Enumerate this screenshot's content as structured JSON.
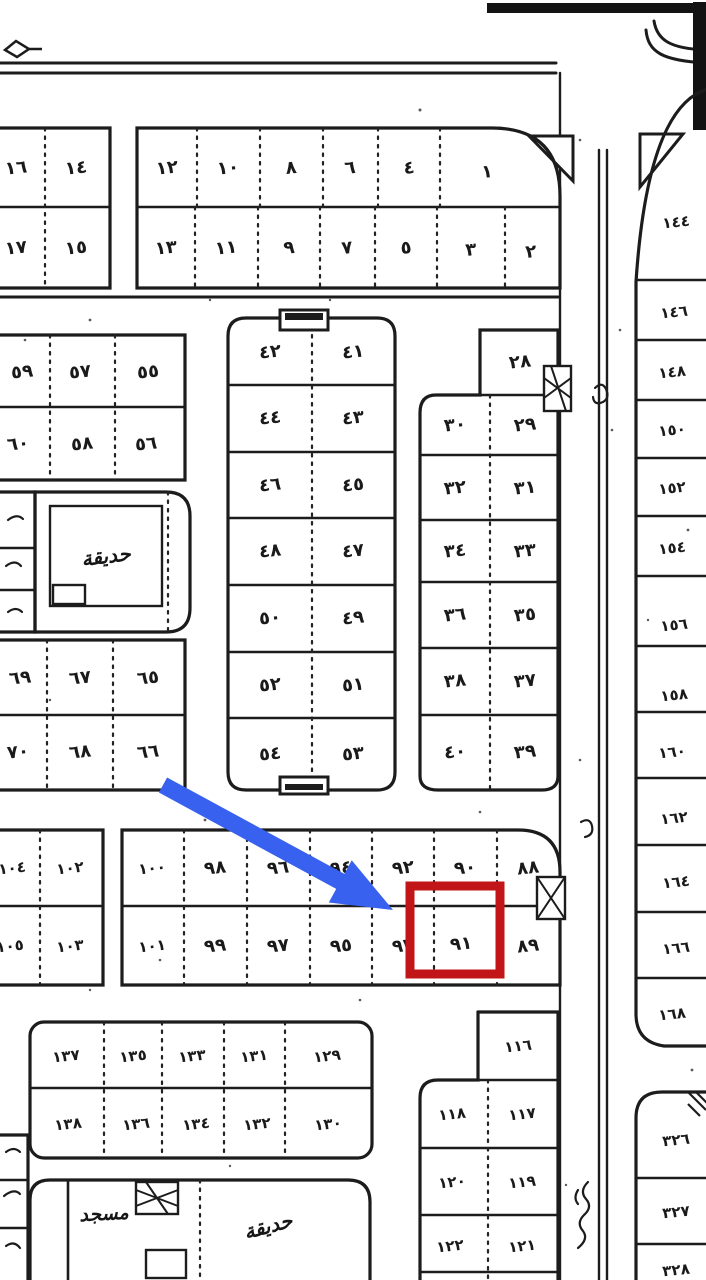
{
  "map": {
    "annotations": {
      "highlighted_plot": "٩١",
      "arrow_color": "#3761ee",
      "highlight_box_color": "#c21518"
    },
    "labels": {
      "garden_upper": "حديقة",
      "mosque": "مسجد",
      "garden_lower": "حديقة"
    },
    "blocks": {
      "top_left": {
        "row_top": [
          "١٦",
          "١٤"
        ],
        "row_bottom": [
          "١٧",
          "١٥"
        ]
      },
      "top_right": {
        "row_top": [
          "١٢",
          "١٠",
          "٨",
          "٦",
          "٤",
          "١"
        ],
        "row_bottom": [
          "١٣",
          "١١",
          "٩",
          "٧",
          "٥",
          "٣",
          "٢"
        ]
      },
      "west_upper": {
        "row_top": [
          "٥٩",
          "٥٧",
          "٥٥"
        ],
        "row_bottom": [
          "٦٠",
          "٥٨",
          "٥٦"
        ]
      },
      "west_lower": {
        "row_top": [
          "٦٩",
          "٦٧",
          "٦٥"
        ],
        "row_bottom": [
          "٧٠",
          "٦٨",
          "٦٦"
        ]
      },
      "central": {
        "col_left": [
          "٤٢",
          "٤٤",
          "٤٦",
          "٤٨",
          "٥٠",
          "٥٢",
          "٥٤"
        ],
        "col_right": [
          "٤١",
          "٤٣",
          "٤٥",
          "٤٧",
          "٤٩",
          "٥١",
          "٥٣"
        ]
      },
      "east_central": {
        "single_top": "٢٨",
        "col_left": [
          "٣٠",
          "٣٢",
          "٣٤",
          "٣٦",
          "٣٨",
          "٤٠"
        ],
        "col_right": [
          "٢٩",
          "٣١",
          "٣٣",
          "٣٥",
          "٣٧",
          "٣٩"
        ]
      },
      "mid_band_west": {
        "row_top": [
          "١٠٤",
          "١٠٢"
        ],
        "row_bottom": [
          "١٠٥",
          "١٠٣"
        ]
      },
      "mid_band_main": {
        "row_top": [
          "١٠٠",
          "٩٨",
          "٩٦",
          "٩٤",
          "٩٢",
          "٩٠",
          "٨٨"
        ],
        "row_bottom": [
          "١٠١",
          "٩٩",
          "٩٧",
          "٩٥",
          "٩٣",
          "٩١",
          "٨٩"
        ]
      },
      "south_west": {
        "row_top": [
          "١٣٧",
          "١٣٥",
          "١٣٣",
          "١٣١",
          "١٢٩"
        ],
        "row_bottom": [
          "١٣٨",
          "١٣٦",
          "١٣٤",
          "١٣٢",
          "١٣٠"
        ]
      },
      "south_central": {
        "single_top": "١١٦",
        "col_left": [
          "١١٨",
          "١٢٠",
          "١٢٢"
        ],
        "col_right": [
          "١١٧",
          "١١٩",
          "١٢١"
        ]
      },
      "east_column": {
        "cells": [
          "١٤٤",
          "١٤٦",
          "١٤٨",
          "١٥٠",
          "١٥٢",
          "١٥٤",
          "١٥٦",
          "١٥٨",
          "١٦٠",
          "١٦٢",
          "١٦٤",
          "١٦٦",
          "١٦٨"
        ]
      },
      "south_east": {
        "cells": [
          "٣٢٦",
          "٣٢٧",
          "٣٢٨"
        ]
      }
    }
  }
}
